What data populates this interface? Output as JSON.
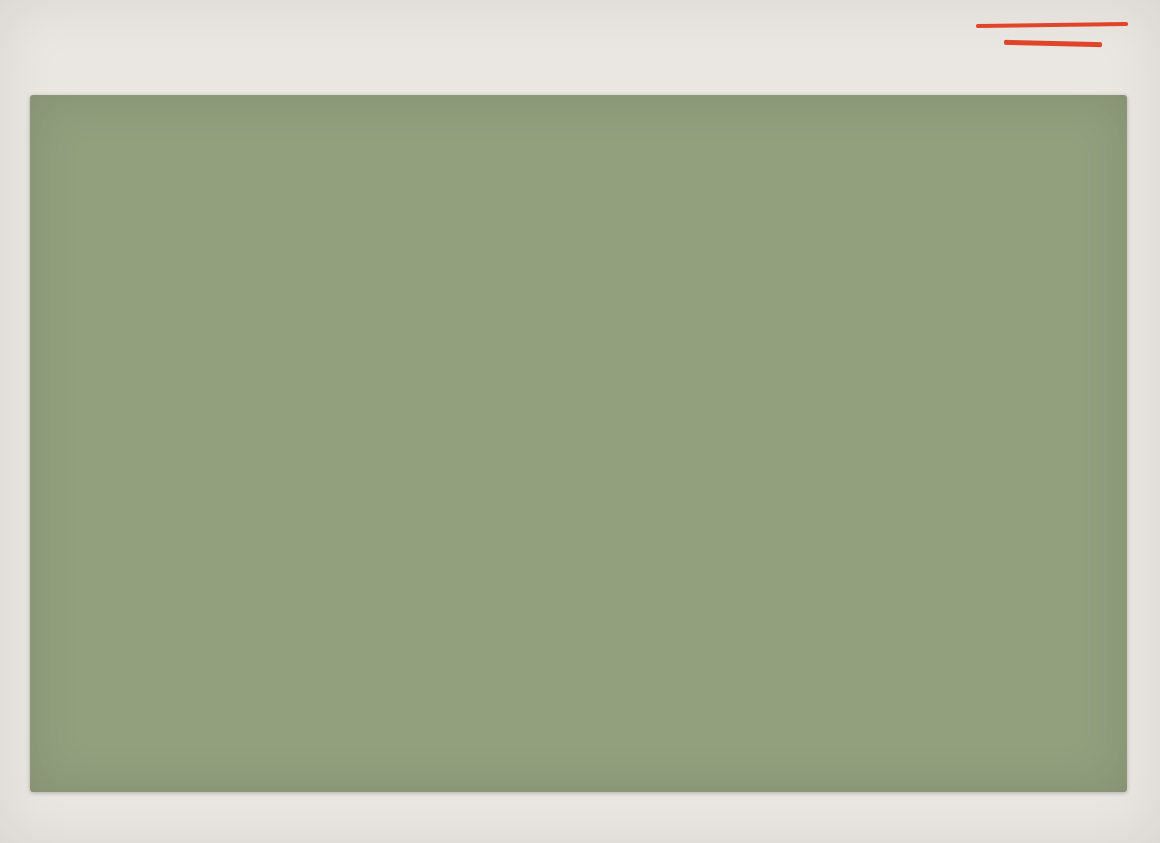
{
  "slide": {
    "title": "ГЕНПЛАН ПОСЁЛКА",
    "page_number": "04"
  },
  "brand": {
    "name_line1": "KRYLOV",
    "name_line2": "DEVELOPMENT",
    "accent_color": "#e0452a"
  },
  "stats": [
    {
      "value": "52,34",
      "unit": "га",
      "label": "площадь поселка"
    },
    {
      "value": "311",
      "unit": "участков",
      "label": "под застройку"
    },
    {
      "value": "2,3",
      "unit": "га",
      "label": "площадь общественного центра"
    },
    {
      "value": "2",
      "unit": "зоны отдыха",
      "label": "для взрослых и детей"
    }
  ],
  "map_labels": {
    "entrance_group": "Въездная группа в поселок",
    "entrance_sign": "Въездной знак",
    "direction_bolkhov": "г. Болхов",
    "direction_oryol": "г. Орёл"
  },
  "map_colors": {
    "parcel_block": "#c9c77e",
    "road": "#f0e9d4",
    "road_edge": "#7c4630",
    "dark_field": "#4e544b",
    "playground": "#d08a3f",
    "utility_line": "#27408f",
    "boundary_line": "#8a4a33"
  }
}
